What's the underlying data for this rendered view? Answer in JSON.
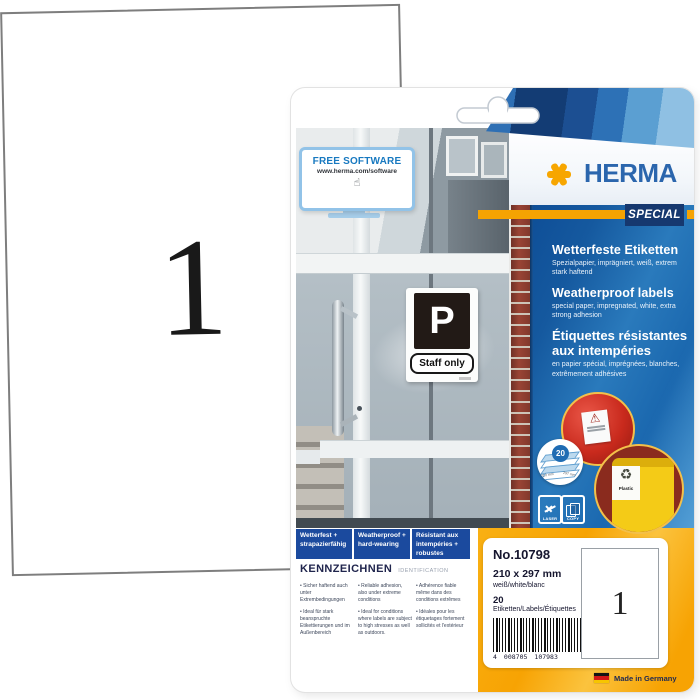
{
  "sheet": {
    "label_count": "1"
  },
  "pkg": {
    "brand": "HERMA",
    "series": "SPECIAL",
    "monitor": {
      "title": "FREE SOFTWARE",
      "url": "www.herma.com/software",
      "hand_glyph": "☝"
    },
    "door_sign": {
      "letter": "P",
      "text": "Staff only"
    },
    "lang": {
      "de": {
        "title": "Wetterfeste Etiketten",
        "sub": "Spezialpapier, imprägniert, weiß, extrem stark haftend"
      },
      "en": {
        "title": "Weatherproof labels",
        "sub": "special paper, impregnated, white, extra strong adhesion"
      },
      "fr": {
        "title": "Étiquettes résistantes aux intempéries",
        "sub": "en papier spécial, imprégnées, blanches, extrêmement adhésives"
      }
    },
    "badge20": {
      "count": "20",
      "dim_w": "210 mm",
      "dim_h": "297 mm"
    },
    "warning_glyph": "⚠",
    "bin": {
      "recycle_glyph": "♻",
      "label": "Plastic"
    },
    "print_icons": {
      "laser": "LASER",
      "copy": "COPY"
    },
    "features": [
      "Wetterfest + strapazierfähig",
      "Weatherproof + hard-wearing",
      "Résistant aux intempéries + robustes"
    ],
    "ident": {
      "heading": "KENNZEICHNEN",
      "subheading": "IDENTIFICATION",
      "cols": [
        {
          "items": [
            "Sicher haftend auch unter Extrembedingungen",
            "Ideal für stark beanspruchte Etikettierungen und im Außenbereich"
          ]
        },
        {
          "items": [
            "Reliable adhesion, also under extreme conditions",
            "Ideal for conditions where labels are subject to high stresses as well as outdoors."
          ]
        },
        {
          "items": [
            "Adhérence fiable même dans des conditions extrêmes",
            "Idéales pour les étiquetages fortement sollicités et l'extérieur"
          ]
        }
      ]
    },
    "info": {
      "number": "No.10798",
      "size": "210 x 297 mm",
      "color": "weiß/white/blanc",
      "count": "20",
      "count_label": "Etiketten/Labels/Étiquettes",
      "barcode": {
        "first": "4",
        "left": "008705",
        "right": "107983"
      },
      "preview_count": "1"
    },
    "made_in": "Made in Germany"
  },
  "colors": {
    "accent_orange": "#f5a302",
    "brand_blue": "#2b66ad",
    "navy": "#16386f",
    "panel_blue": "#1a67ae",
    "feature_blue": "#1b4a9e",
    "bottom_orange": "#f7a303",
    "brick_red": "#9a4335"
  }
}
